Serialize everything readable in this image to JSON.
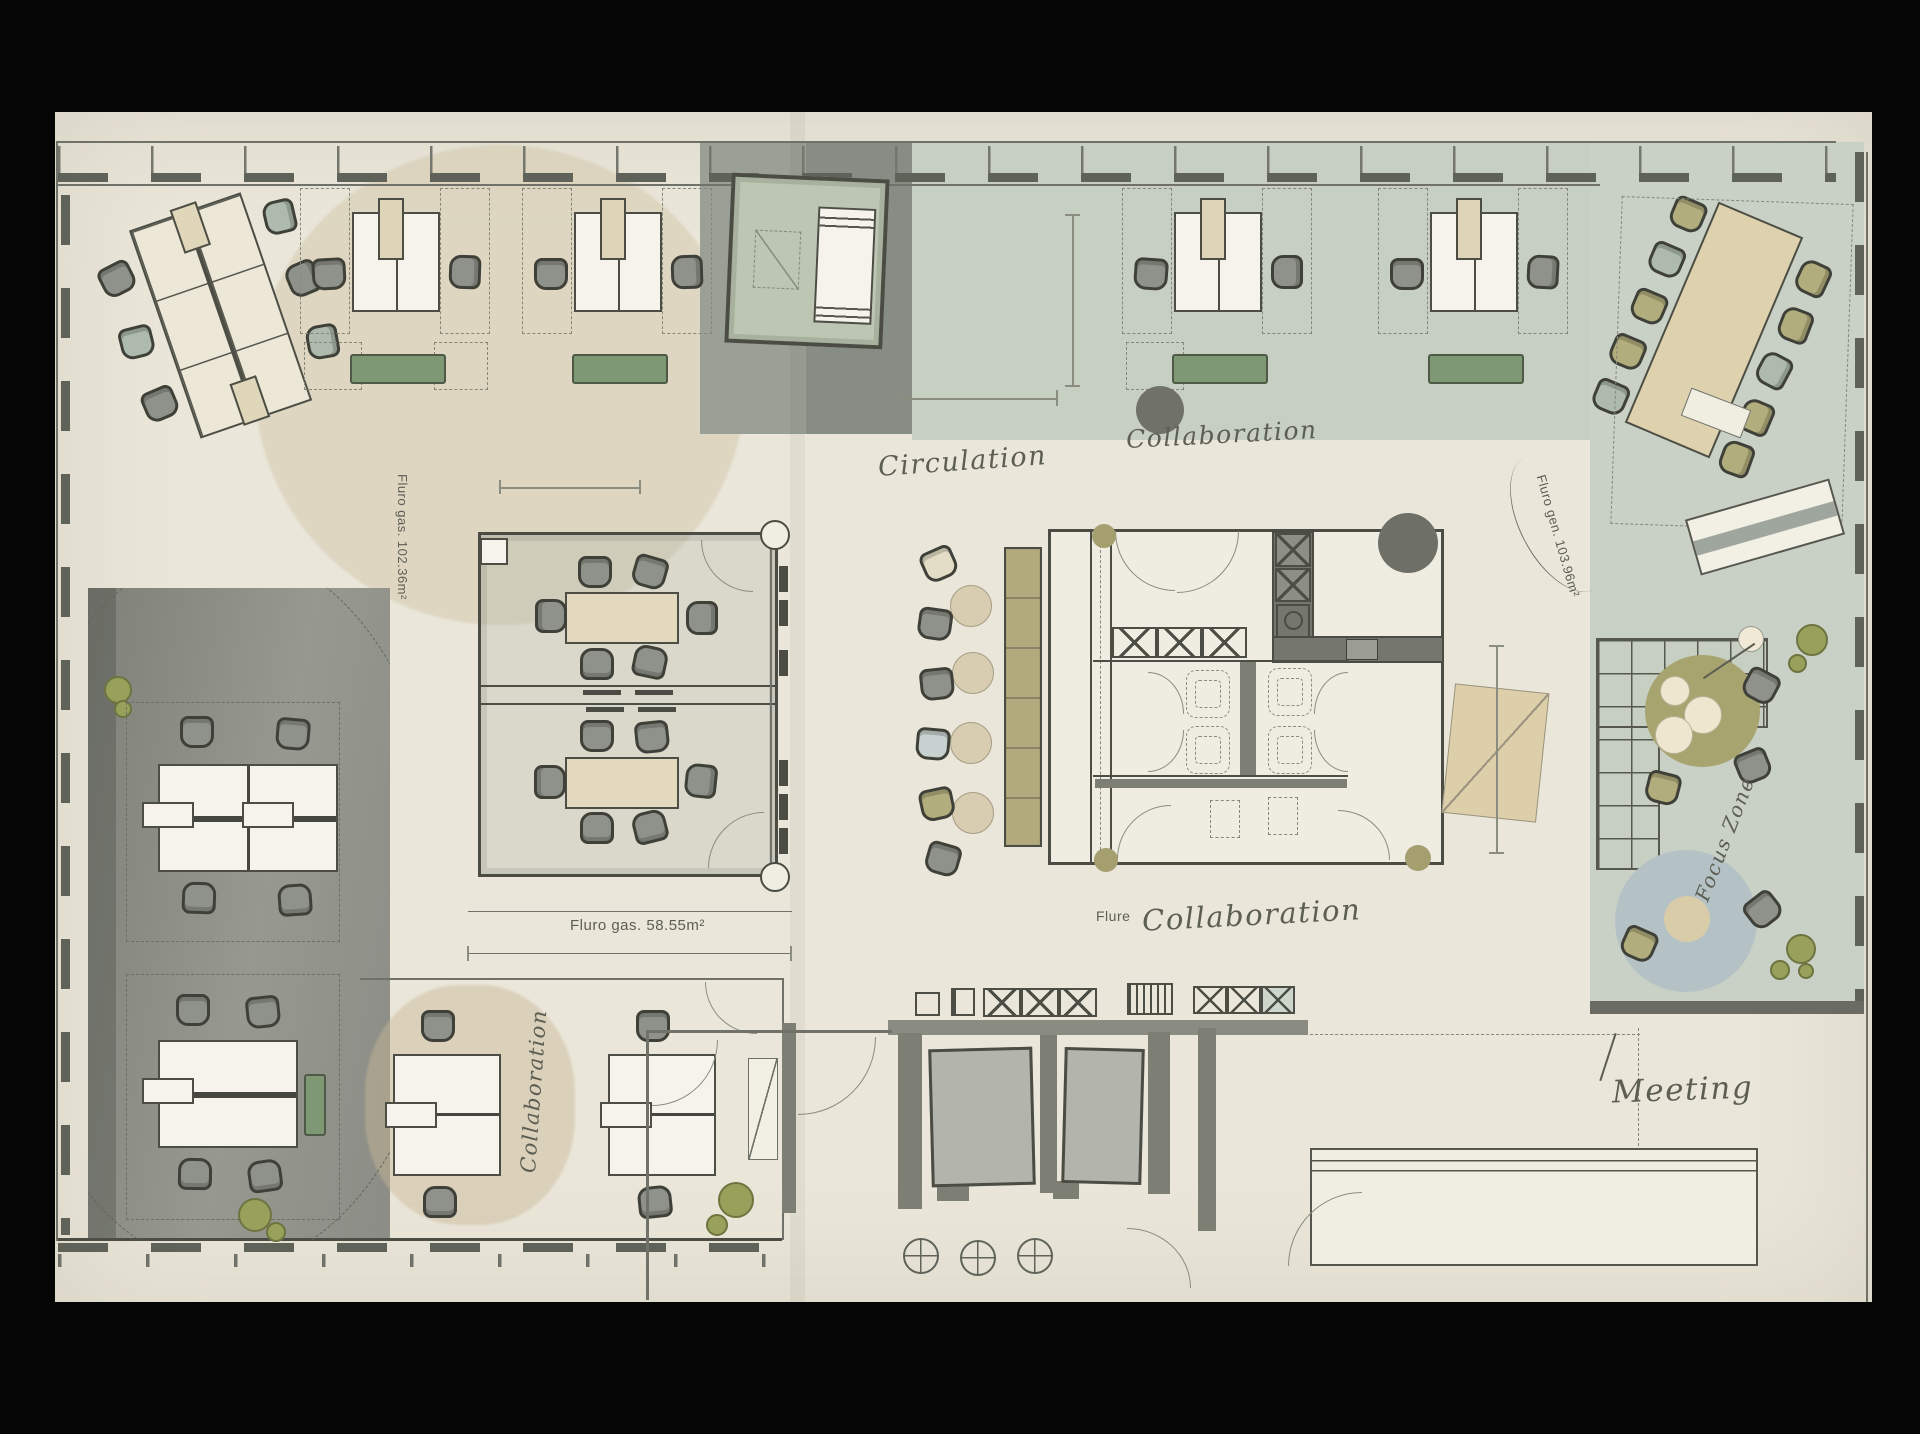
{
  "title": "Hand-drawn watercolor office floor plan",
  "labels": {
    "circulation": "Circulation",
    "collaboration_top": "Collaboration",
    "collaboration_center": "Collaboration",
    "collaboration_left_wing": "Collaboration",
    "focus_zone": "Focus Zone",
    "meeting": "Meeting",
    "flure": "Flure",
    "area_left": "Fluro gas. 102.36m²",
    "area_right": "Fluro gen. 103.96m²",
    "area_center": "Fluro gas. 58.55m²"
  },
  "zones": [
    "Circulation",
    "Collaboration",
    "Focus Zone",
    "Meeting",
    "Flure"
  ],
  "colors": {
    "paper": "#eae6d9",
    "ink": "#4c4e45",
    "sage_zone": "#c9d1c5",
    "gray_zone": "#9aa096",
    "dark_zone": "#8a8c84",
    "desk_white": "#f5f3eb",
    "table_tan": "#e3d9bf",
    "bench_green": "#7d9873",
    "banquette_olive": "#b2aa7d",
    "focus_rug": "#b5c2c5",
    "chair_gray": "#8f928a",
    "chair_olive": "#b2ad7c",
    "chair_sage": "#adbaac"
  }
}
